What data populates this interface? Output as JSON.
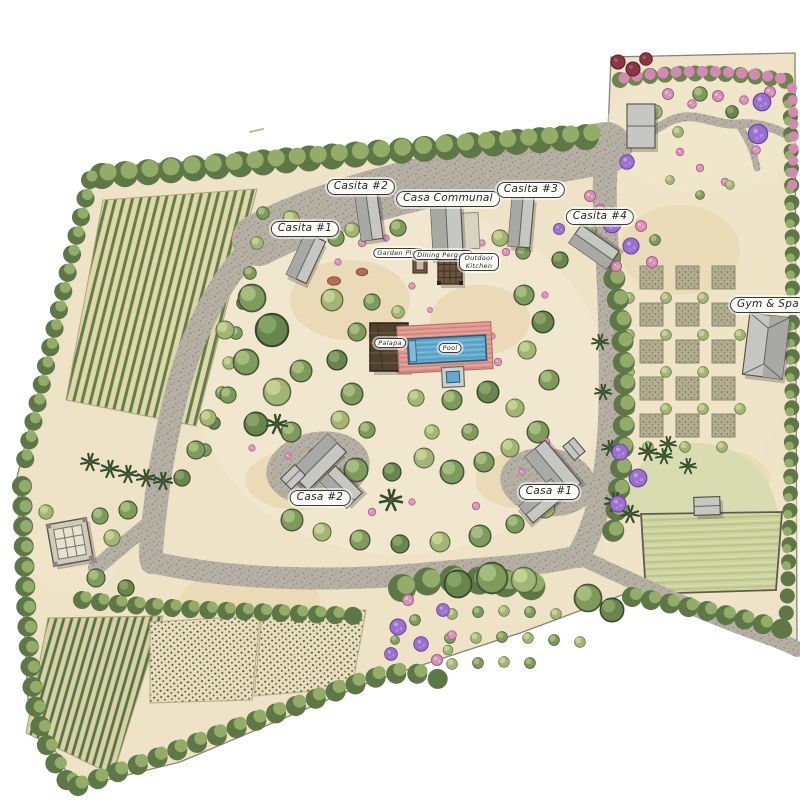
{
  "map": {
    "type": "illustrated landscape master plan",
    "style": "hand-drawn watercolor site plan",
    "labels": {
      "casita1": "Casita #1",
      "casita2": "Casita #2",
      "casita3": "Casita #3",
      "casita4": "Casita #4",
      "casa_communal": "Casa Communal",
      "casa1": "Casa #1",
      "casa2": "Casa #2",
      "gym_spa": "Gym & Spa",
      "garden_plot": "Garden Plot",
      "dining_pergola": "Dining Pergola",
      "outdoor_kitchen": "Outdoor Kitchen",
      "palapa": "Palapa",
      "pool": "Pool"
    },
    "colors": {
      "paper": "#ffffff",
      "sand": "#eee3c7",
      "gravel": "#b6b0a4",
      "canopy": "#7e9b5c",
      "vine_row": "#5f7d4a",
      "water": "#61a9cd",
      "pool_deck": "#de978e",
      "roof": "#c6c6c2",
      "lawn": "#cdd49f",
      "bloom_pink": "#d791b5",
      "bloom_purple": "#9b70cf",
      "label_ink": "#262622"
    }
  }
}
